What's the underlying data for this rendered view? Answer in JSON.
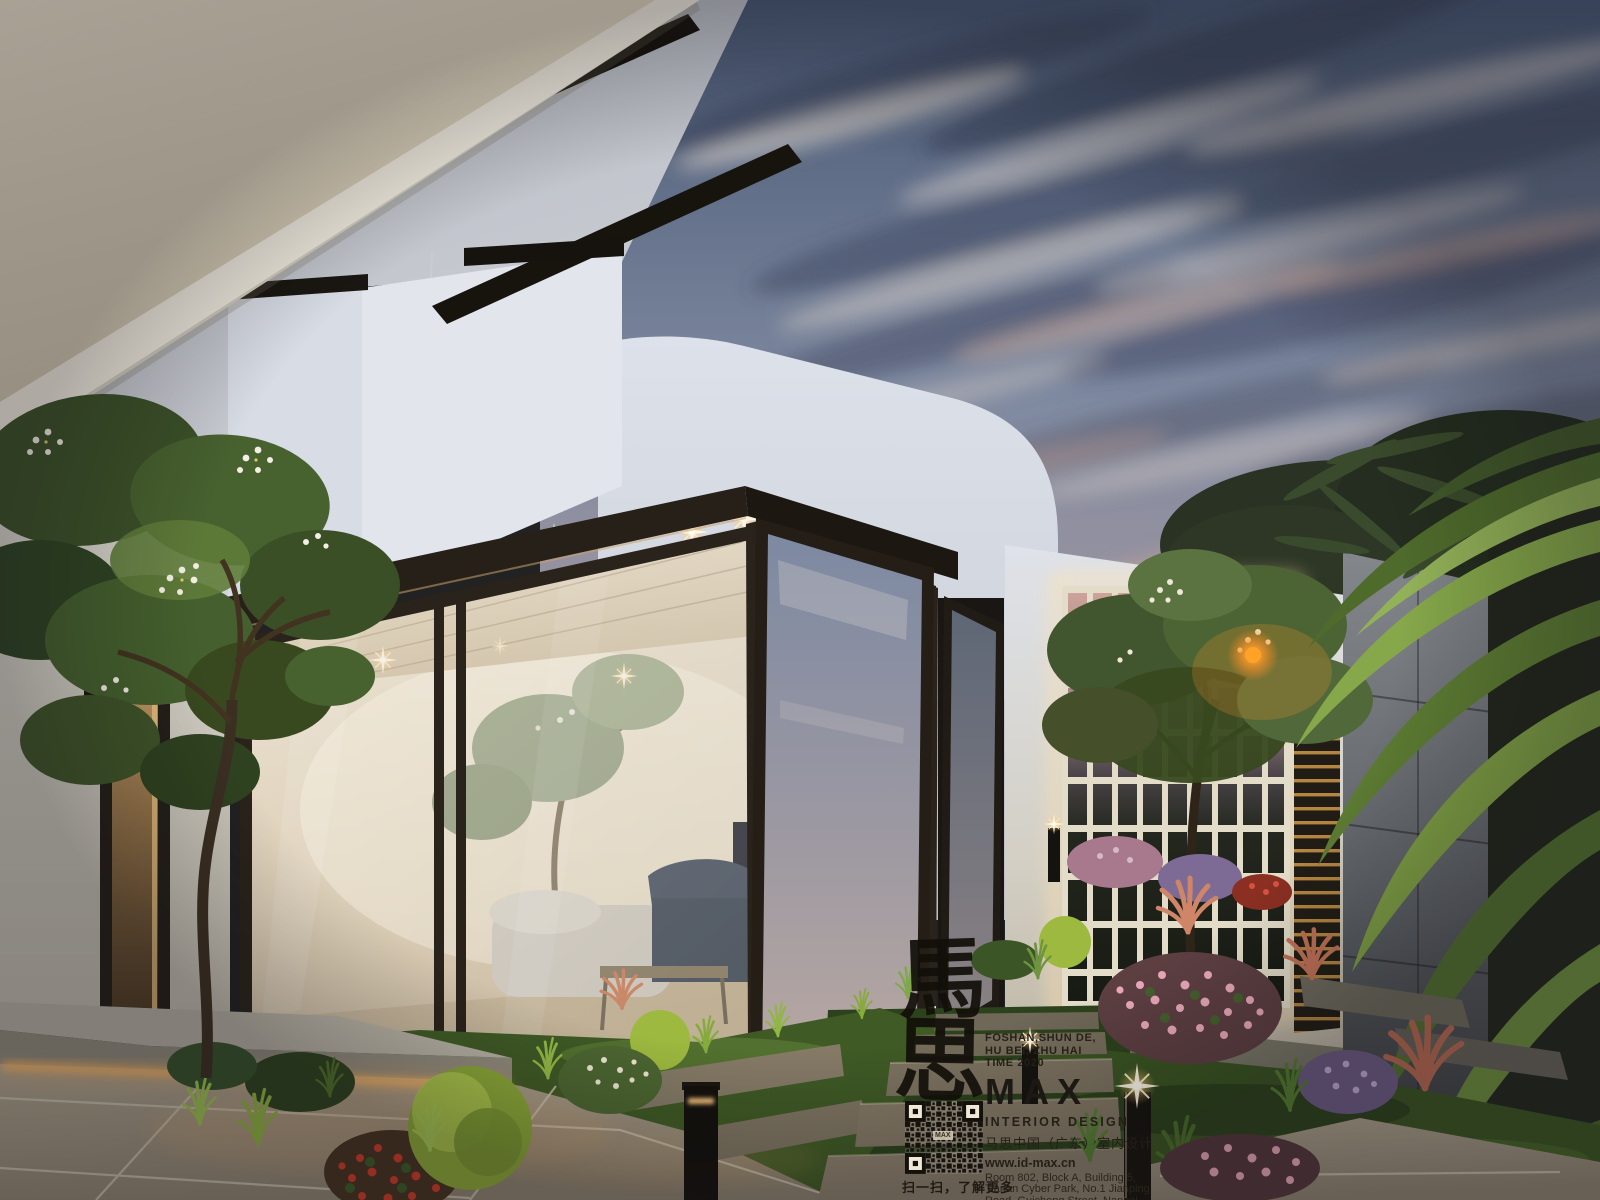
{
  "watermark": {
    "calligraphy_chars": [
      "馬",
      "思"
    ],
    "location_line1": "FOSHAN,SHUN DE,",
    "location_line2": "HU BEI, ZHU HAI",
    "time_line": "TIME 2020",
    "logo_text": "MAX",
    "subtitle_en": "INTERIOR DESIGN",
    "subtitle_cn": "马思中国（广东）室内设计",
    "website": "www.id-max.cn",
    "address_lines": [
      "Room 802, Block A, Building 5,",
      "Tianan Cyber Park, No.1 Jianping",
      "Road, Guicheng Street, Nanhai",
      "District,Foshan City, Guangdong",
      "Province, China"
    ],
    "qr_center_label": "MAX",
    "qr_caption": "扫一扫，了解更多"
  },
  "colors": {
    "sky_top": "#4e5d78",
    "sky_horizon": "#c7a49e",
    "soffit_cream": "#e4dac3",
    "frame_dark": "#262019",
    "warm_light": "#ffb763",
    "foliage_green": "#55743a",
    "lawn_green": "#3f5a25",
    "tile_beige": "#a3977f",
    "stone_gray": "#5d6165",
    "watermark_ink": "#201c15"
  }
}
